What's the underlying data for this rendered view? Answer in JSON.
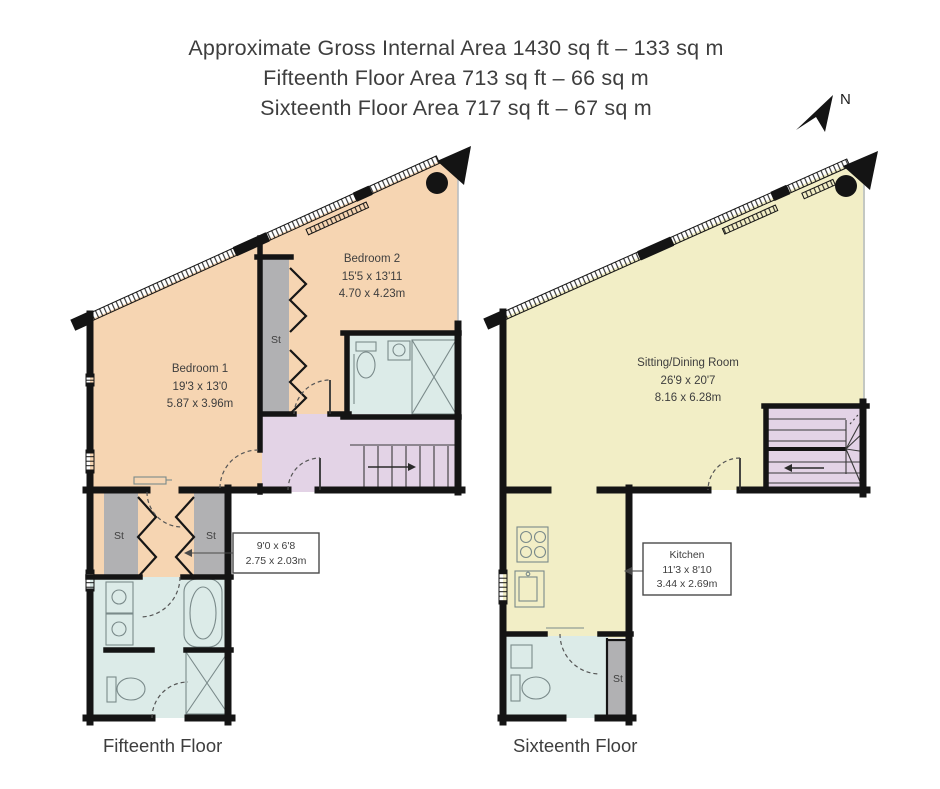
{
  "header": {
    "line1": "Approximate Gross Internal Area 1430 sq ft – 133 sq m",
    "line2": "Fifteenth Floor Area 713 sq ft – 66 sq m",
    "line3": "Sixteenth Floor Area 717 sq ft – 67 sq m"
  },
  "compass": {
    "north_label": "N"
  },
  "floors": {
    "fifteenth": {
      "name": "Fifteenth Floor",
      "rooms": {
        "bedroom1": {
          "name": "Bedroom 1",
          "imperial": "19'3 x 13'0",
          "metric": "5.87 x 3.96m"
        },
        "bedroom2": {
          "name": "Bedroom 2",
          "imperial": "15'5 x 13'11",
          "metric": "4.70 x 4.23m"
        },
        "dressing": {
          "imperial": "9'0 x 6'8",
          "metric": "2.75 x 2.03m"
        },
        "storage_mid": {
          "label": "St"
        },
        "storage_left": {
          "label": "St"
        },
        "storage_right": {
          "label": "St"
        }
      }
    },
    "sixteenth": {
      "name": "Sixteenth Floor",
      "rooms": {
        "sitting_dining": {
          "name": "Sitting/Dining Room",
          "imperial": "26'9 x 20'7",
          "metric": "8.16 x 6.28m"
        },
        "kitchen": {
          "name": "Kitchen",
          "imperial": "11'3 x 8'10",
          "metric": "3.44 x 2.69m"
        },
        "storage": {
          "label": "St"
        }
      }
    }
  },
  "colors": {
    "bedroom": "#f6d5b2",
    "living": "#f2eec6",
    "hall": "#e3d3e6",
    "bathroom": "#dcebe8",
    "storage": "#b1b1b3",
    "wall": "#141414",
    "text": "#3e3e3e"
  }
}
